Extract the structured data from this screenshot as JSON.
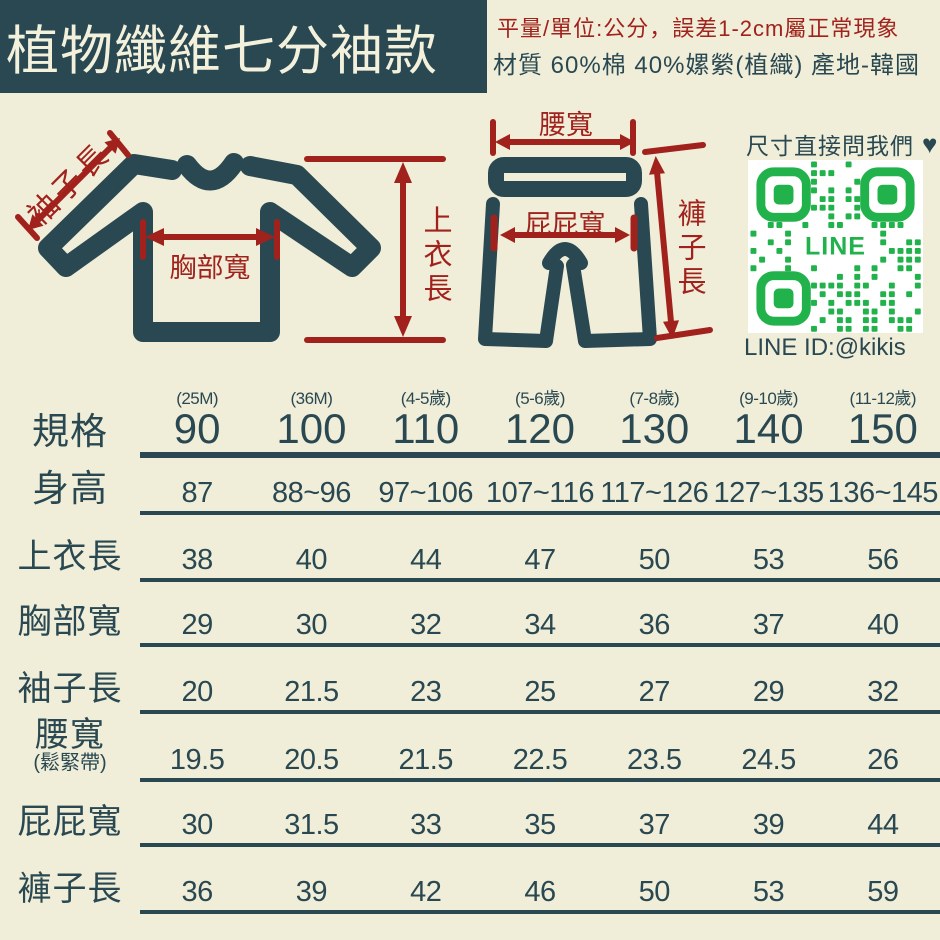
{
  "banner": {
    "title": "植物纖維七分袖款"
  },
  "header_notes": {
    "measure_note": "平量/單位:公分，誤差1-2cm屬正常現象",
    "material_note": "材質 60%棉 40%嫘縈(植織) 產地-韓國"
  },
  "diagram": {
    "shirt": {
      "sleeve_length_label": "袖子長",
      "chest_width_label": "胸部寬",
      "top_length_label": "上衣長"
    },
    "pants": {
      "waist_width_label": "腰寬",
      "hip_width_label": "屁屁寬",
      "pants_length_label": "褲子長"
    }
  },
  "contact": {
    "ask_us_label": "尺寸直接問我們",
    "heart_icon": "♥",
    "qr_center_label": "LINE",
    "line_id": "LINE ID:@kikis"
  },
  "size_table": {
    "spec_label": "規格",
    "columns": [
      {
        "age": "(25M)",
        "size": "90"
      },
      {
        "age": "(36M)",
        "size": "100"
      },
      {
        "age": "(4-5歲)",
        "size": "110"
      },
      {
        "age": "(5-6歲)",
        "size": "120"
      },
      {
        "age": "(7-8歲)",
        "size": "130"
      },
      {
        "age": "(9-10歲)",
        "size": "140"
      },
      {
        "age": "(11-12歲)",
        "size": "150"
      }
    ],
    "rows": [
      {
        "label": "身高",
        "sublabel": "",
        "values": [
          "87",
          "88~96",
          "97~106",
          "107~116",
          "117~126",
          "127~135",
          "136~145"
        ]
      },
      {
        "label": "上衣長",
        "sublabel": "",
        "values": [
          "38",
          "40",
          "44",
          "47",
          "50",
          "53",
          "56"
        ]
      },
      {
        "label": "胸部寬",
        "sublabel": "",
        "values": [
          "29",
          "30",
          "32",
          "34",
          "36",
          "37",
          "40"
        ]
      },
      {
        "label": "袖子長",
        "sublabel": "",
        "values": [
          "20",
          "21.5",
          "23",
          "25",
          "27",
          "29",
          "32"
        ]
      },
      {
        "label": "腰寬",
        "sublabel": "(鬆緊帶)",
        "values": [
          "19.5",
          "20.5",
          "21.5",
          "22.5",
          "23.5",
          "24.5",
          "26"
        ]
      },
      {
        "label": "屁屁寬",
        "sublabel": "",
        "values": [
          "30",
          "31.5",
          "33",
          "35",
          "37",
          "39",
          "44"
        ]
      },
      {
        "label": "褲子長",
        "sublabel": "",
        "values": [
          "36",
          "39",
          "42",
          "46",
          "50",
          "53",
          "59"
        ]
      }
    ]
  },
  "colors": {
    "background": "#f0eed8",
    "ink_teal": "#2a4852",
    "accent_red": "#a1221d",
    "qr_green": "#22b24c",
    "banner_text": "#f3f1dc"
  }
}
